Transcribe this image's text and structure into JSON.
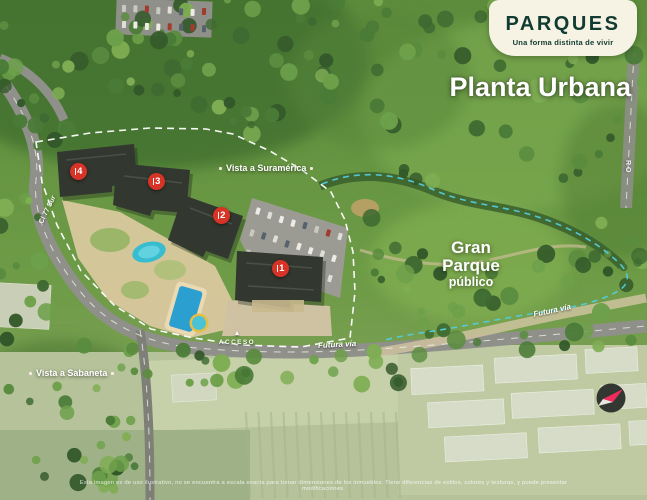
{
  "brand": {
    "name": "PARQUES",
    "tagline": "Una forma distinta de vivir"
  },
  "page_title": "Planta Urbana",
  "map_labels": {
    "vista_suramerica": "Vista a Suramérica",
    "vista_sabaneta": "Vista a Sabaneta",
    "gran_parque_line1": "Gran",
    "gran_parque_line2": "Parque",
    "gran_parque_line3": "público",
    "acceso": "ACCESO",
    "acceso_arrow": "▲",
    "futura_via_bottom": "Futura vía",
    "futura_via_right": "Futura vía",
    "road_left": "Cl 77 Sur",
    "road_right": "RO"
  },
  "tower_markers": [
    {
      "number": "4"
    },
    {
      "number": "3"
    },
    {
      "number": "2"
    },
    {
      "number": "1"
    }
  ],
  "footer": {
    "disclaimer": "Esta imagen es de uso ilustrativo, no se encuentra a escala exacta para tomar dimensiones de los inmuebles. Tiene diferencias de estilos, colores y texturas, y puede presentar modificaciones."
  },
  "colors": {
    "brand_green": "#123c31",
    "badge_cream": "#f6f2e4",
    "marker_red": "#d73327",
    "boundary_white": "#ffffff",
    "park_teal": "#52ccdd",
    "compass_pink": "#ee2d5c"
  }
}
